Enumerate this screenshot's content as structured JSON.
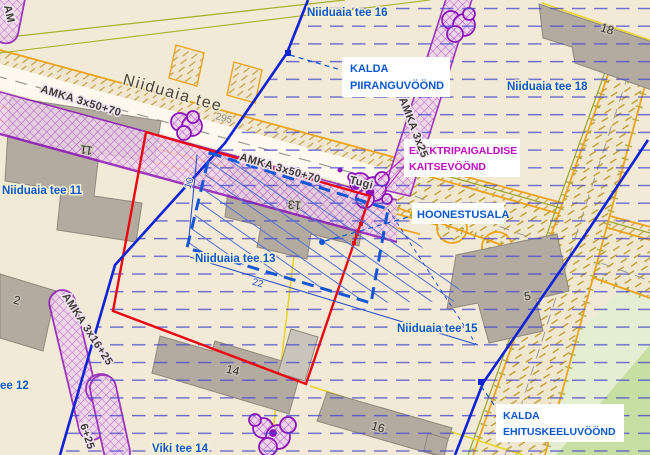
{
  "labels": {
    "street_main": "Niiduaia tee",
    "parcels": {
      "tee16": "Niiduaia tee 16",
      "tee18": "Niiduaia tee 18",
      "tee11": "Niiduaia tee 11",
      "tee13": "Niiduaia tee 13",
      "tee15": "Niiduaia tee 15",
      "tee12_partial": "ee 12",
      "viki": "Viki tee 14"
    }
  },
  "annotations": {
    "kalda_piiranguvoond": {
      "line1": "KALDA",
      "line2": "PIIRANGUVÖÖND"
    },
    "elektripaigaldise_kaitsevoond": {
      "line1": "ELEKTRIPAIGALDISE",
      "line2": "KAITSEVÖÖND"
    },
    "hoonestusala": {
      "line1": "HOONESTUSALA"
    },
    "kalda_ehituskeeluvoond": {
      "line1": "KALDA",
      "line2": "EHITUSKEELUVÖÖND"
    }
  },
  "cables": {
    "amka_50_70_west": "AMKA 3x50+70",
    "amka_50_70_center": "AMKA 3x50+70",
    "amka_25_north": "AMKA 3x25",
    "amka_16_25_southwest": "AMKA 3x16+25",
    "amka_fragment_south": "6+25",
    "amka_fragment_corner": "AM",
    "pole_label": "Tugi"
  },
  "buildings": {
    "b11": "11",
    "b13": "13",
    "b18": "18",
    "b5": "5",
    "b14": "14",
    "b16": "16",
    "b12_partial": "2"
  },
  "measurements": {
    "setback_10": "10",
    "length_22": "22",
    "road_number_295": "295"
  },
  "colors": {
    "background": "#f2e9d6",
    "red_plot_boundary": "#ea0613",
    "blue_zone_boundary": "#1023d8",
    "label_blue": "#0b57d0",
    "magenta_annotation": "#c00ac0",
    "purple_cable_corridor": "#8a10b8",
    "orange_road_edge": "#eca41c",
    "olive_line": "#9aa526",
    "yellow_line": "#e8d520",
    "building_gray": "#b4aba0",
    "green_area": "#c8dfa4",
    "hoonestusala_blue": "#1456d8"
  }
}
